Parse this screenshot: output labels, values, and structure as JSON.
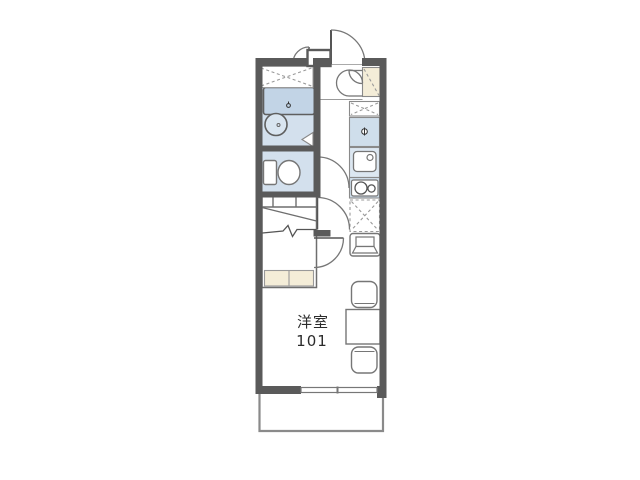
{
  "page": {
    "background_color": "#ffffff"
  },
  "floor_plan": {
    "room_label": {
      "name": "洋室",
      "number": "101"
    },
    "colors": {
      "wall": "#5a5a5a",
      "wet_area_floor": "#d3e0ed",
      "bathtub_fill": "#c2d4e6",
      "kitchen_unit_fill": "#cfdeeb",
      "sink_unit_fill": "#dce7f1",
      "storage_cream_fill": "#f4edd8",
      "furniture_outline": "#767676",
      "dashed_line": "#999999",
      "label_text": "#2b2b2b"
    },
    "icons": [
      {
        "name": "entrance-door-arc-icon"
      },
      {
        "name": "meter-box-icon"
      },
      {
        "name": "shoe-cabinet-icon"
      },
      {
        "name": "storage-shelf-icon"
      },
      {
        "name": "washing-machine-space-icon"
      },
      {
        "name": "kitchen-counter-faucet-icon"
      },
      {
        "name": "kitchen-sink-icon"
      },
      {
        "name": "stove-burners-icon"
      },
      {
        "name": "refrigerator-space-icon"
      },
      {
        "name": "bathtub-icon"
      },
      {
        "name": "wash-basin-icon"
      },
      {
        "name": "toilet-icon"
      },
      {
        "name": "bed-icon"
      },
      {
        "name": "tv-stand-icon"
      },
      {
        "name": "table-icon"
      },
      {
        "name": "chair-icon"
      },
      {
        "name": "window-icon"
      },
      {
        "name": "balcony-icon"
      }
    ]
  }
}
